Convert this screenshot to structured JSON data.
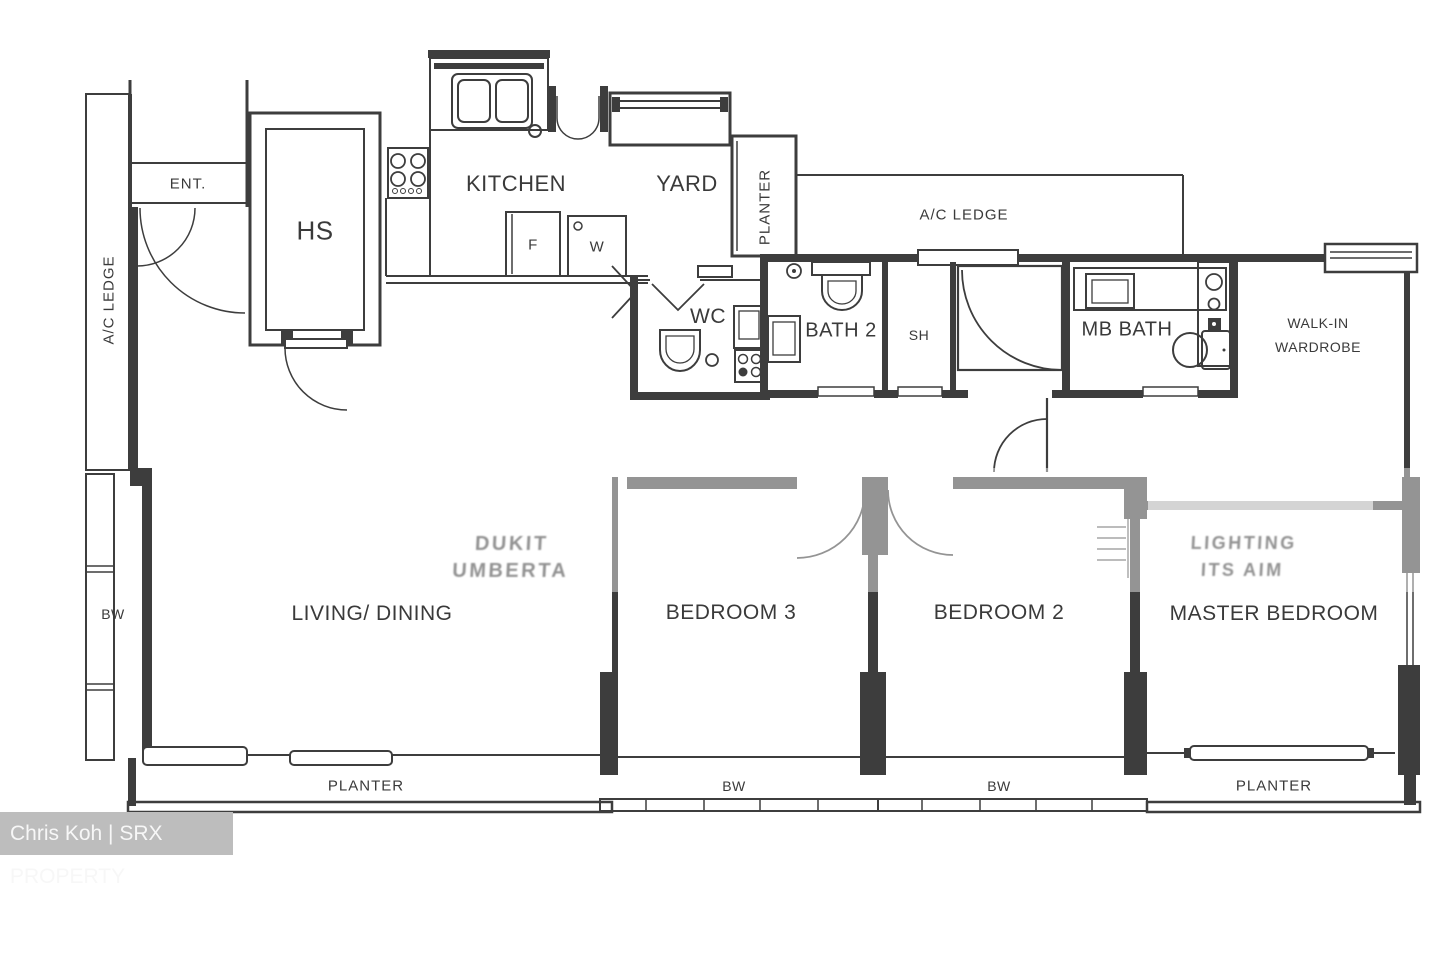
{
  "rooms": {
    "ent": "ENT.",
    "hs": "HS",
    "kitchen": "KITCHEN",
    "yard": "YARD",
    "wc": "WC",
    "bath2": "BATH 2",
    "sh": "SH",
    "mb_bath": "MB BATH",
    "wiw1": "WALK-IN",
    "wiw2": "WARDROBE",
    "living": "LIVING/ DINING",
    "bedroom3": "BEDROOM 3",
    "bedroom2": "BEDROOM 2",
    "master": "MASTER BEDROOM"
  },
  "features": {
    "ac_ledge_left": "A/C LEDGE",
    "ac_ledge_top": "A/C LEDGE",
    "planter_yard": "PLANTER",
    "planter_living": "PLANTER",
    "planter_master": "PLANTER",
    "bw_left": "BW",
    "bw_bedroom3": "BW",
    "bw_bedroom2": "BW",
    "fridge": "F",
    "washer": "W"
  },
  "watermarks": {
    "credit": "Chris Koh | SRX PROPERTY",
    "ghost_left_line1": "DUKIT",
    "ghost_left_line2": "UMBERTA",
    "ghost_right_line1": "LIGHTING",
    "ghost_right_line2": "ITS AIM"
  },
  "colors": {
    "wall": "#3d3d3d",
    "label": "#3a3a3a",
    "credit_bg": "#bdbdbd",
    "credit_text": "#f7f7f7"
  }
}
